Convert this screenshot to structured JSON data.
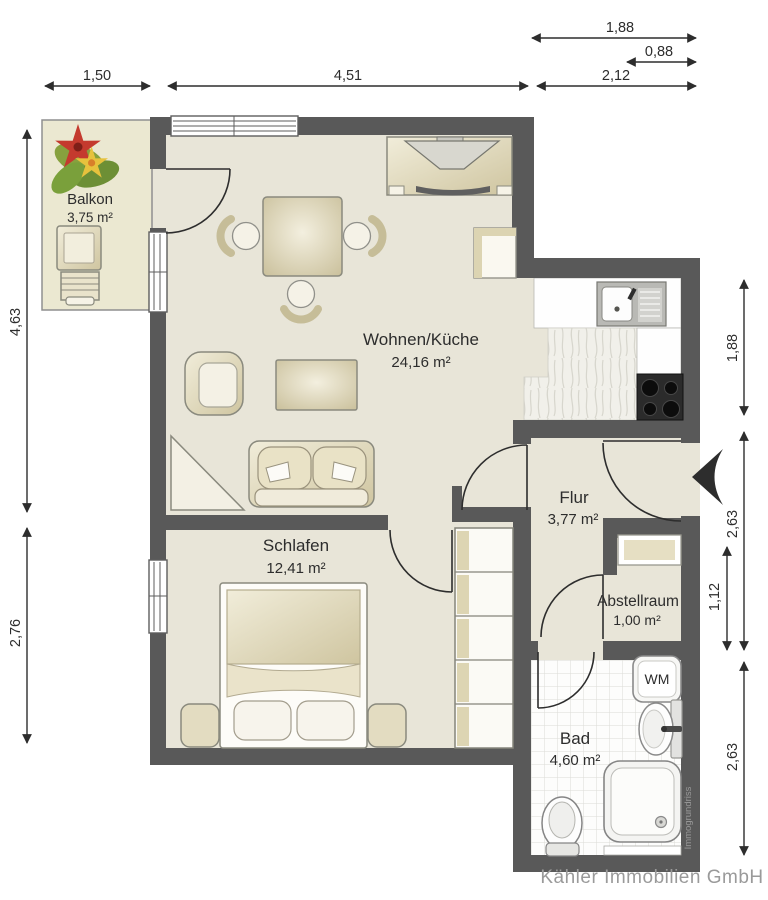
{
  "floorplan": {
    "company": "Kähler Immobilien GmbH",
    "watermark": "Immogrundriss",
    "rooms": {
      "balkon": {
        "name": "Balkon",
        "area": "3,75 m²"
      },
      "wohnen_kueche": {
        "name": "Wohnen/Küche",
        "area": "24,16 m²"
      },
      "schlafen": {
        "name": "Schlafen",
        "area": "12,41 m²"
      },
      "flur": {
        "name": "Flur",
        "area": "3,77 m²"
      },
      "abstellraum": {
        "name": "Abstellraum",
        "area": "1,00 m²"
      },
      "bad": {
        "name": "Bad",
        "area": "4,60 m²"
      }
    },
    "appliances": {
      "washing_machine_label": "WM"
    },
    "dimensions_m": {
      "top": [
        "1,88",
        "0,88",
        "1,50",
        "4,51",
        "2,12"
      ],
      "left": [
        "4,63",
        "2,76"
      ],
      "right": [
        "1,88",
        "2,63",
        "1,12",
        "2,63"
      ]
    },
    "colors": {
      "wall": "#595959",
      "floor": "#e8e5d8",
      "balcony_floor": "#ebe8d1",
      "furniture_beige": "#d8d0ae",
      "kitchen_white": "#fefefe",
      "dimension_text": "#2d2d2d",
      "watermark_gray": "#9a9a9a"
    }
  }
}
